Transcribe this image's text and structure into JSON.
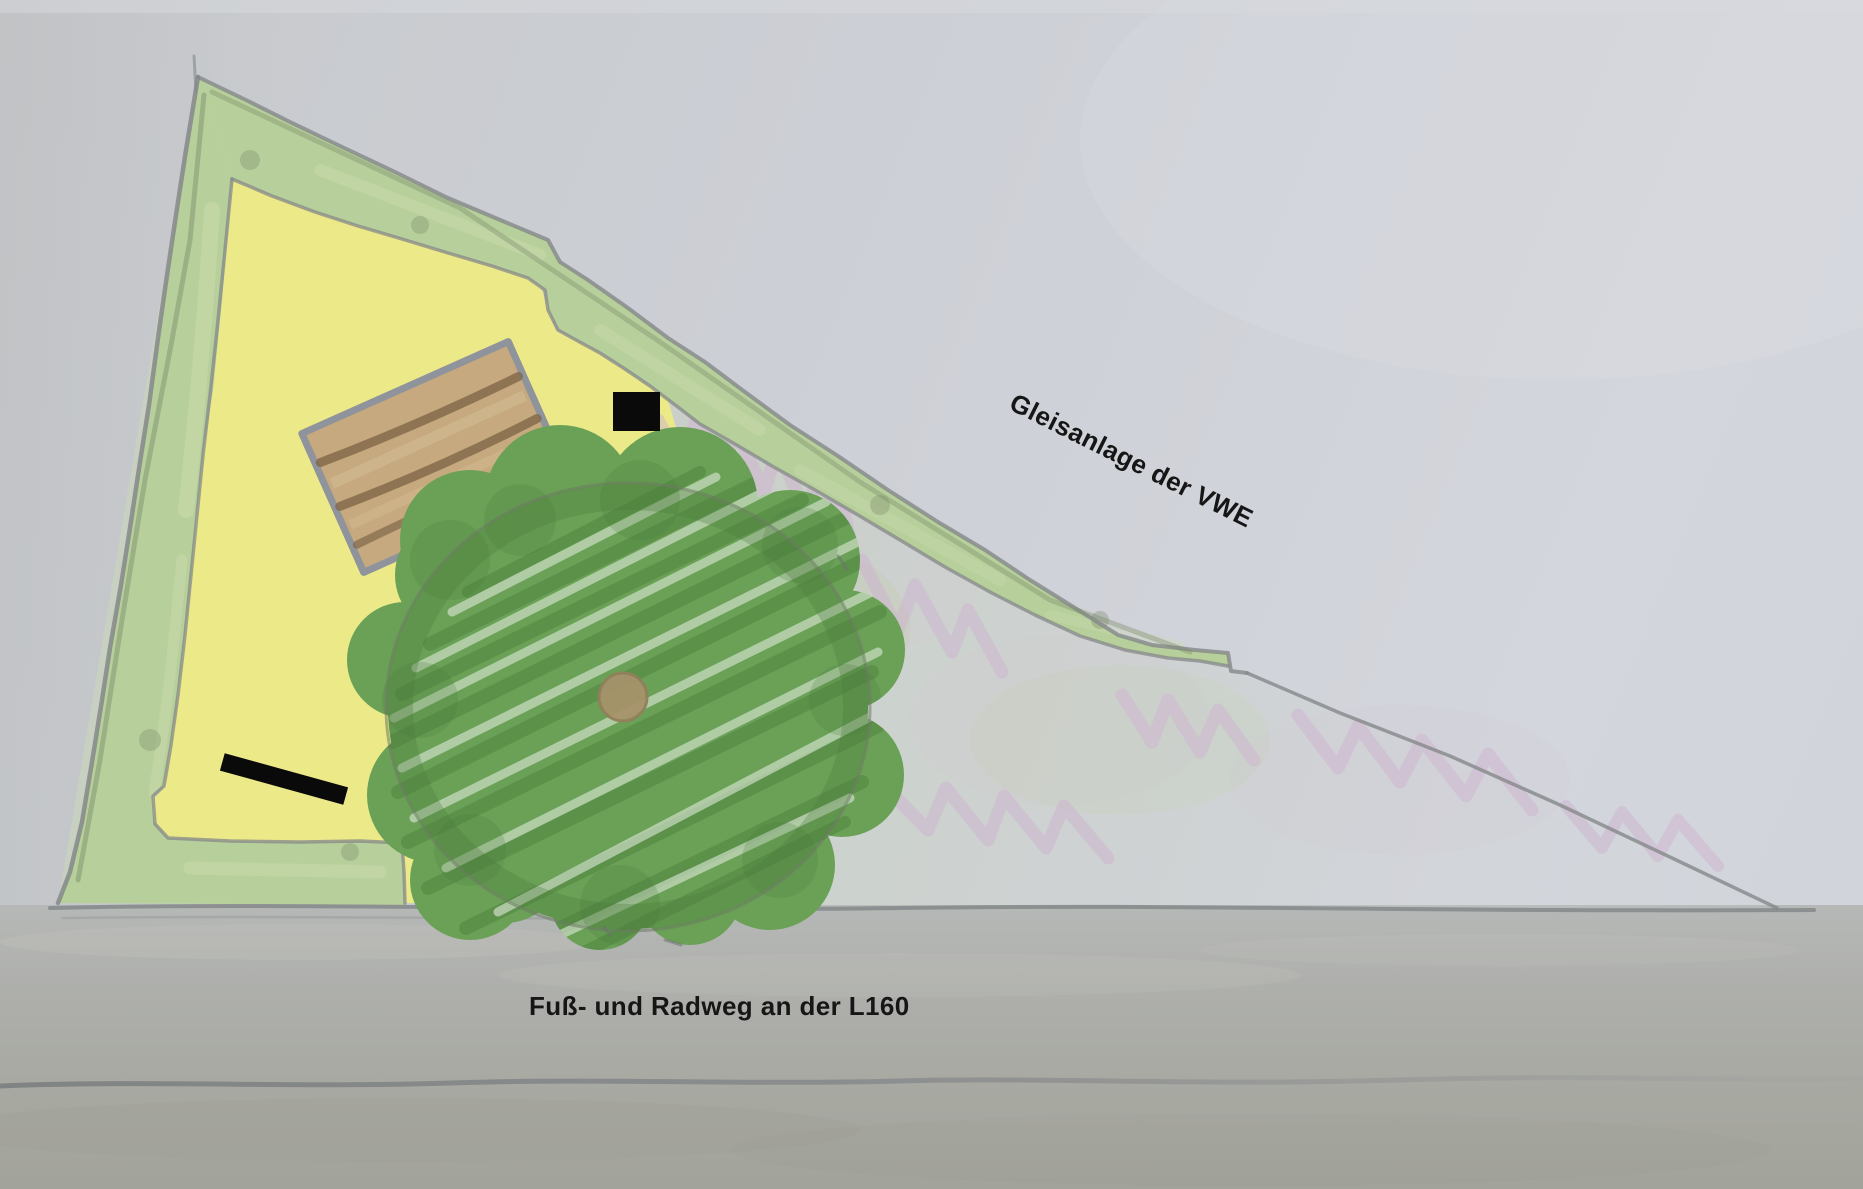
{
  "labels": {
    "railway": "Gleisanlage der VWE",
    "footpath": "Fuß- und Radweg an der L160"
  },
  "colors": {
    "paper_top": "#d3d6dc",
    "paper_mid": "#cccfd5",
    "paper_left": "#c7c9cc",
    "ground_upper": "#b6b8b7",
    "ground_lower": "#a2a39a",
    "pencil": "#85888a",
    "pencil_dark": "#6d7172",
    "hedge": "#b7d09b",
    "hedge_edge": "#7c8a6a",
    "hedge_light": "#cddcae",
    "lawn_yellow": "#ece989",
    "interior_tint": "#c7d1c0",
    "tree": "#6aa156",
    "tree_dark": "#4a7c3a",
    "tree_light": "#dfeada",
    "tree_outline": "#6b7a63",
    "trunk": "#a6936b",
    "table_fill": "#c6a97e",
    "table_plank": "#7b6346",
    "table_light": "#d6bf97",
    "table_border": "#8f939b",
    "marker_black": "#0a0a0a",
    "scribble_pink": "#cdb4cf",
    "label_text": "#161616"
  },
  "features": [
    "plot-outline",
    "hedge-border",
    "lawn-area",
    "tree-canopy",
    "tree-trunk",
    "wooden-table",
    "black-square-marker",
    "black-bar-marker",
    "railway-scribbles",
    "ground-line",
    "fold-line"
  ]
}
